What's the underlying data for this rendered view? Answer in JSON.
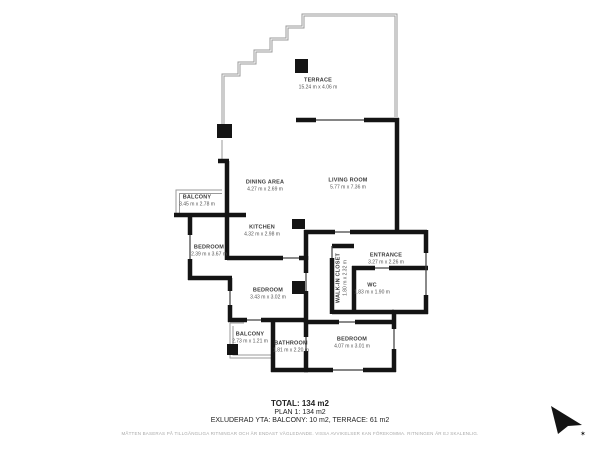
{
  "floorplan": {
    "rooms": [
      {
        "name": "TERRACE",
        "dims": "15.24 m x 4.06 m"
      },
      {
        "name": "DINING AREA",
        "dims": "4.27 m x 2.69 m"
      },
      {
        "name": "LIVING ROOM",
        "dims": "5.77 m x 7.36 m"
      },
      {
        "name": "KITCHEN",
        "dims": "4.32 m x 2.98 m"
      },
      {
        "name": "BALCONY",
        "dims": "3.45 m x 2.78 m"
      },
      {
        "name": "BEDROOM",
        "dims": "2.39 m x 3.67 m"
      },
      {
        "name": "BEDROOM",
        "dims": "3.43 m x 3.02 m"
      },
      {
        "name": "WALK-IN CLOSET",
        "dims": "1.80 m x 2.32 m"
      },
      {
        "name": "ENTRANCE",
        "dims": "3.27 m x 2.26 m"
      },
      {
        "name": "WC",
        "dims": "1.83 m x 1.90 m"
      },
      {
        "name": "BALCONY",
        "dims": "2.73 m x 1.21 m"
      },
      {
        "name": "BATHROOM",
        "dims": "1.81 m x 2.20 m"
      },
      {
        "name": "BEDROOM",
        "dims": "4.07 m x 3.01 m"
      }
    ],
    "footer": {
      "total": "TOTAL: 134 m2",
      "plan": "PLAN 1: 134 m2",
      "excluded": "EXLUDERAD YTA: BALCONY: 10 m2, TERRACE: 61 m2",
      "disclaimer": "MÅTTEN BASERAS PÅ TILLGÄNGLIGA RITNINGAR OCH ÄR ENDAST VÄGLEDANDE. VISSA AVVIKELSER KAN FÖREKOMMA. RITNINGEN ÄR EJ SKALENLIG."
    },
    "icons": {
      "north_star": "✶"
    },
    "colors": {
      "wall": "#141414",
      "thin_line": "#3c3c3c",
      "light_line": "#9a9a9a"
    }
  }
}
